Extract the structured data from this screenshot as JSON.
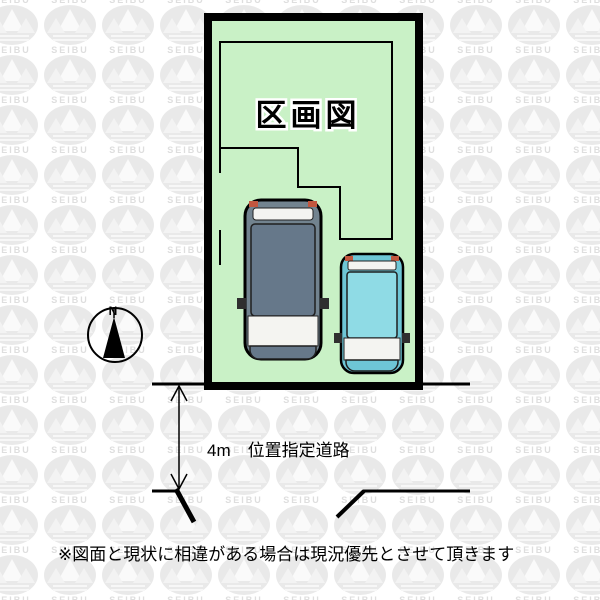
{
  "diagram": {
    "title": "区画図",
    "road_label": "4m　位置指定道路",
    "disclaimer": "※図面と現状に相違がある場合は現況優先とさせて頂きます",
    "compass_north": "N",
    "watermark_text": "SEIBU",
    "colors": {
      "plot_fill": "#c9f1c6",
      "outline": "#000000",
      "large_car_body": "#72838f",
      "large_car_roof": "#66788a",
      "small_car_body": "#6ec6d6",
      "small_car_roof": "#8fdbe5",
      "window_glass": "#f4f4f1",
      "tail_light": "#c2573f",
      "watermark_grey": "#e9e9e9"
    }
  }
}
